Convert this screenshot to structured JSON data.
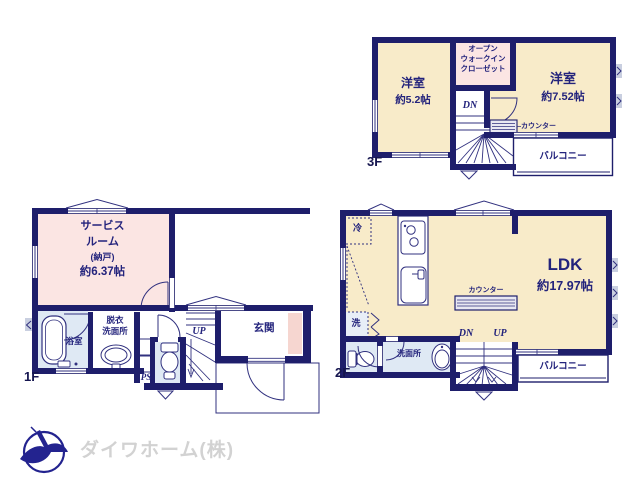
{
  "floors": {
    "f3": {
      "label": "3F",
      "room1_name": "洋室",
      "room1_size": "約5.2帖",
      "owic_l1": "オープン",
      "owic_l2": "ウォークイン",
      "owic_l3": "クローゼット",
      "room2_name": "洋室",
      "room2_size": "約7.52帖",
      "counter": "カウンター",
      "balcony": "バルコニー",
      "stairs_dn": "DN"
    },
    "f2": {
      "label": "2F",
      "ldk_name": "LDK",
      "ldk_size": "約17.97帖",
      "counter": "カウンター",
      "balcony": "バルコニー",
      "fridge": "冷",
      "washer": "洗",
      "washroom": "洗面所",
      "stairs_dn": "DN",
      "stairs_up": "UP"
    },
    "f1": {
      "label": "1F",
      "service_l1": "サービス",
      "service_l2": "ルーム",
      "service_l3": "(納戸)",
      "service_l4": "約6.37帖",
      "bath": "浴室",
      "dressing_l1": "脱衣",
      "dressing_l2": "洗面所",
      "entrance": "玄関",
      "ps": "PS",
      "stairs_up": "UP"
    },
    "logo": {
      "company": "ダイワホーム(株)"
    },
    "colors": {
      "wall": "#1e1e6b",
      "room_cream": "#f8ebc9",
      "room_pink": "#fbe5e3",
      "wet_blue": "#dfe9f4",
      "entry_pink": "#f6d6d0",
      "logo_blue": "#23238f",
      "logo_gray": "#d2d2d2",
      "label_navy": "#23237c"
    }
  }
}
